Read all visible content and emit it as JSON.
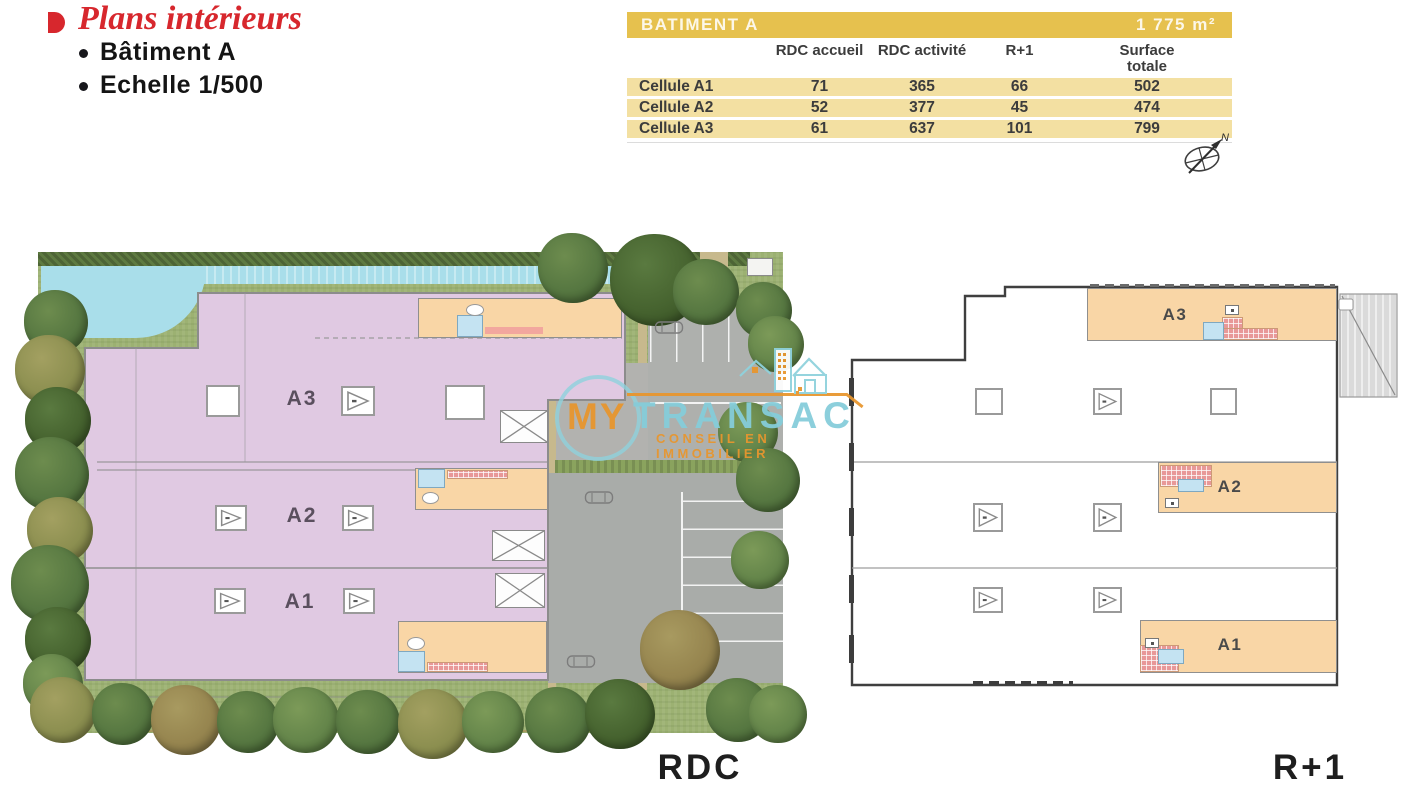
{
  "header": {
    "title": "Plans intérieurs",
    "bullets": [
      "Bâtiment A",
      "Echelle 1/500"
    ]
  },
  "surface_table": {
    "title": "BATIMENT A",
    "total_area": "1 775 m²",
    "columns": [
      "RDC accueil",
      "RDC activité",
      "R+1",
      "Surface totale"
    ],
    "rows": [
      {
        "label": "Cellule A1",
        "values": [
          "71",
          "365",
          "66",
          "502"
        ]
      },
      {
        "label": "Cellule A2",
        "values": [
          "52",
          "377",
          "45",
          "474"
        ]
      },
      {
        "label": "Cellule A3",
        "values": [
          "61",
          "637",
          "101",
          "799"
        ]
      }
    ]
  },
  "compass": {
    "north_label": "N"
  },
  "rdc_plan": {
    "label": "RDC",
    "zone_labels": [
      "A3",
      "A2",
      "A1"
    ]
  },
  "r1_plan": {
    "label": "R+1",
    "room_labels": [
      "A3",
      "A2",
      "A1"
    ]
  },
  "watermark": {
    "brand_first": "MY",
    "brand_second": "TRANSAC",
    "tagline": "CONSEIL EN IMMOBILIER"
  },
  "colors": {
    "title_red": "#d7272d",
    "table_gold": "#e6c14e",
    "table_row_gold": "#f3e0a2",
    "plan_pink": "#e0c9e2",
    "plan_peach": "#f9d6a6",
    "brand_orange": "#e8962e",
    "brand_teal": "#85cdda"
  }
}
